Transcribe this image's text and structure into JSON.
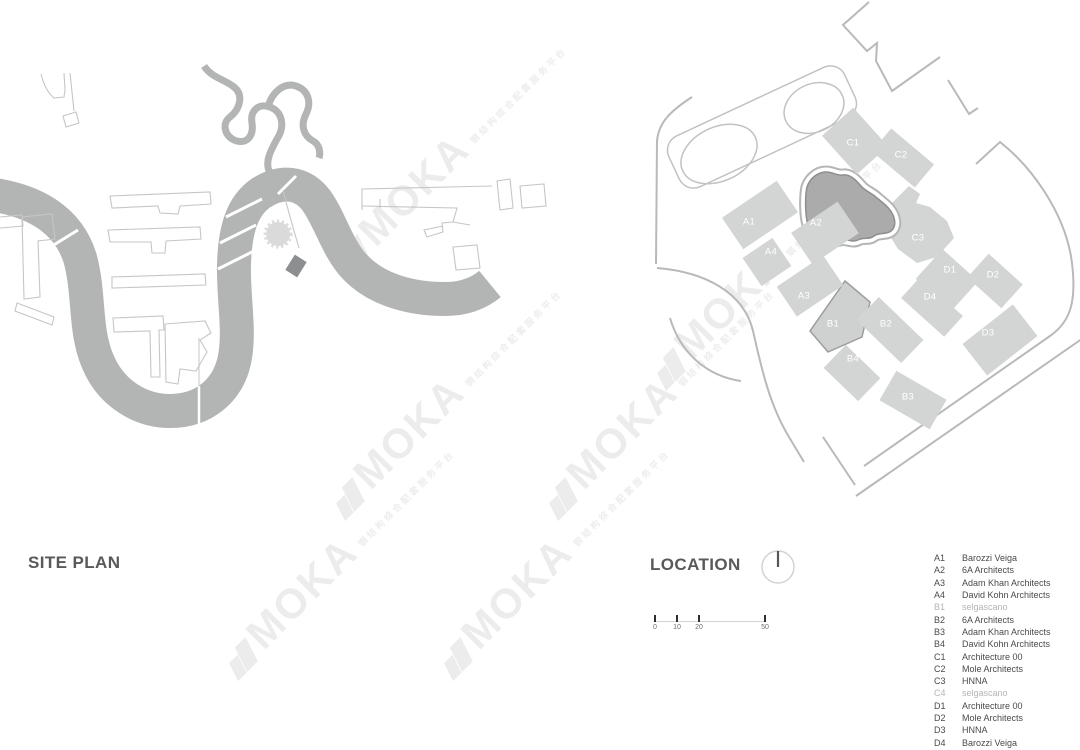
{
  "site_plan": {
    "title": "SITE PLAN"
  },
  "location": {
    "title": "LOCATION",
    "scale_bar": {
      "ticks": [
        {
          "x": 4,
          "label": "0"
        },
        {
          "x": 26,
          "label": "10"
        },
        {
          "x": 48,
          "label": "20"
        },
        {
          "x": 114,
          "label": "50"
        }
      ]
    },
    "blocks": [
      {
        "label": "A1",
        "cx": 140,
        "cy": 215,
        "w": 66,
        "h": 38,
        "rot": -34,
        "lx": 123,
        "ly": 222
      },
      {
        "label": "A2",
        "cx": 205,
        "cy": 233,
        "w": 56,
        "h": 38,
        "rot": -34,
        "lx": 190,
        "ly": 223
      },
      {
        "label": "A3",
        "cx": 190,
        "cy": 286,
        "w": 56,
        "h": 36,
        "rot": -34,
        "lx": 178,
        "ly": 296
      },
      {
        "label": "A4",
        "cx": 147,
        "cy": 262,
        "w": 36,
        "h": 34,
        "rot": -34,
        "lx": 145,
        "ly": 252
      },
      {
        "label": "B1",
        "shape": "none",
        "lx": 207,
        "ly": 324
      },
      {
        "label": "B2",
        "cx": 270,
        "cy": 330,
        "w": 62,
        "h": 32,
        "rot": 44,
        "lx": 260,
        "ly": 324
      },
      {
        "label": "B3",
        "cx": 293,
        "cy": 400,
        "w": 58,
        "h": 34,
        "rot": 30,
        "lx": 282,
        "ly": 397
      },
      {
        "label": "B4",
        "cx": 232,
        "cy": 373,
        "w": 48,
        "h": 32,
        "rot": 44,
        "lx": 227,
        "ly": 359
      },
      {
        "label": "C1",
        "cx": 235,
        "cy": 141,
        "w": 52,
        "h": 42,
        "rot": 48,
        "lx": 227,
        "ly": 143
      },
      {
        "label": "C2",
        "cx": 283,
        "cy": 158,
        "w": 56,
        "h": 30,
        "rot": 40,
        "lx": 275,
        "ly": 155
      },
      {
        "label": "C3",
        "shape": "none",
        "lx": 292,
        "ly": 238
      },
      {
        "label": "D1",
        "cx": 327,
        "cy": 280,
        "w": 48,
        "h": 40,
        "rot": 42,
        "lx": 324,
        "ly": 270
      },
      {
        "label": "D2",
        "cx": 375,
        "cy": 281,
        "w": 46,
        "h": 32,
        "rot": 42,
        "lx": 367,
        "ly": 275
      },
      {
        "label": "D3",
        "cx": 380,
        "cy": 340,
        "w": 64,
        "h": 40,
        "rot": -38,
        "lx": 362,
        "ly": 333
      },
      {
        "label": "D4",
        "cx": 312,
        "cy": 307,
        "w": 58,
        "h": 28,
        "rot": 42,
        "lx": 304,
        "ly": 297
      }
    ]
  },
  "legend": {
    "entries": [
      {
        "code": "A1",
        "name": "Barozzi Veiga",
        "muted": false
      },
      {
        "code": "A2",
        "name": "6A Architects",
        "muted": false
      },
      {
        "code": "A3",
        "name": "Adam Khan Architects",
        "muted": false
      },
      {
        "code": "A4",
        "name": "David Kohn Architects",
        "muted": false
      },
      {
        "code": "B1",
        "name": "selgascano",
        "muted": true
      },
      {
        "code": "B2",
        "name": "6A Architects",
        "muted": false
      },
      {
        "code": "B3",
        "name": "Adam Khan Architects",
        "muted": false
      },
      {
        "code": "B4",
        "name": "David Kohn Architects",
        "muted": false
      },
      {
        "code": "C1",
        "name": "Architecture 00",
        "muted": false
      },
      {
        "code": "C2",
        "name": "Mole Architects",
        "muted": false
      },
      {
        "code": "C3",
        "name": "HNNA",
        "muted": false
      },
      {
        "code": "C4",
        "name": "selgascano",
        "muted": true
      },
      {
        "code": "D1",
        "name": "Architecture 00",
        "muted": false
      },
      {
        "code": "D2",
        "name": "Mole Architects",
        "muted": false
      },
      {
        "code": "D3",
        "name": "HNNA",
        "muted": false
      },
      {
        "code": "D4",
        "name": "Barozzi Veiga",
        "muted": false
      }
    ]
  },
  "watermark": {
    "brand": "MOKA",
    "tagline": "钢结构综合配套服务平台",
    "positions": [
      {
        "x": 352,
        "y": 272
      },
      {
        "x": 668,
        "y": 385
      },
      {
        "x": 347,
        "y": 515
      },
      {
        "x": 560,
        "y": 515
      },
      {
        "x": 240,
        "y": 675
      },
      {
        "x": 455,
        "y": 675
      }
    ]
  },
  "colors": {
    "river": "#b3b4b4",
    "block_fill": "#d3d4d4",
    "block_label": "#ffffff",
    "site_highlight": "#ababab",
    "site_outline": "#8e8e8e",
    "road": "#b9b9b9",
    "outline": "#c6c6c6",
    "title_text": "#58595b",
    "legend_text": "#4a4a4a",
    "legend_muted": "#b4b4b4"
  }
}
